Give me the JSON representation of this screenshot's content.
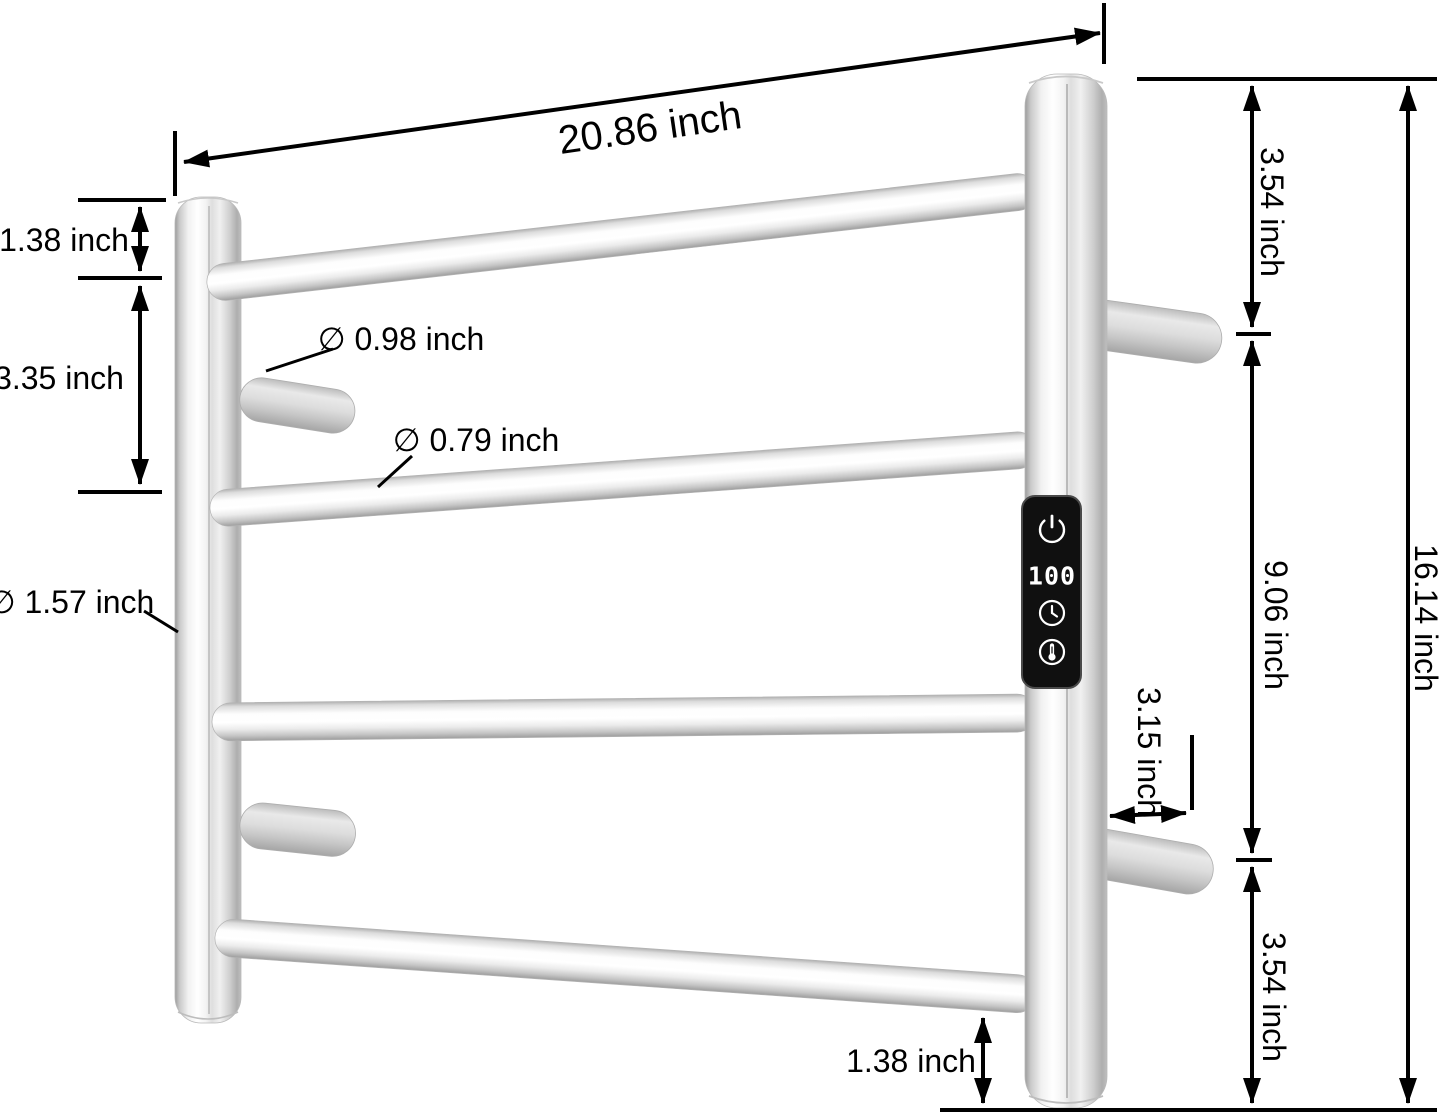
{
  "dimensions": {
    "top_width": "20.86 inch",
    "left_top_gap": "1.38 inch",
    "left_bar_spacing": "3.35 inch",
    "mount_bar_diameter": "∅ 0.98 inch",
    "rail_diameter": "∅ 0.79 inch",
    "post_diameter": "∅ 1.57 inch",
    "right_top_section": "3.54 inch",
    "right_middle_section": "9.06 inch",
    "total_height": "16.14 inch",
    "standoff_depth": "3.15 inch",
    "right_bottom_section": "3.54 inch",
    "bottom_gap": "1.38 inch"
  },
  "panel": {
    "display_value": "100",
    "icons": [
      "power-icon",
      "timer-icon",
      "temperature-icon"
    ],
    "background_color": "#101010",
    "foreground_color": "#ffffff"
  },
  "colors": {
    "background": "#ffffff",
    "dimension_lines": "#000000",
    "metal_highlight": "#ffffff",
    "metal_mid": "#d8d8d8",
    "metal_shadow": "#a0a0a0"
  }
}
